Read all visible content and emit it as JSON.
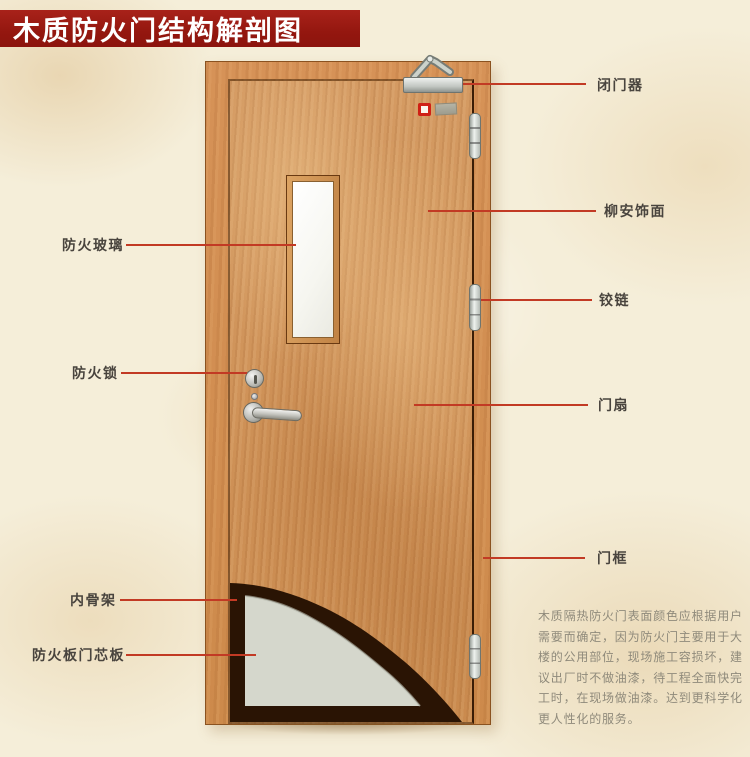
{
  "title": "木质防火门结构解剖图",
  "callouts": {
    "fire_glass": "防火玻璃",
    "fire_lock": "防火锁",
    "inner_skeleton": "内骨架",
    "fire_board_core": "防火板门芯板",
    "door_closer": "闭门器",
    "lauan_veneer": "柳安饰面",
    "hinge": "铰链",
    "door_leaf": "门扇",
    "door_frame": "门框"
  },
  "description": {
    "lines": [
      "木质隔热防火门表面颜色应根据用户",
      "需要而确定，因为防火门主要用于大",
      "楼的公用部位，现场施工容损坏，建",
      "议出厂时不做油漆，待工程全面快完",
      "工时，在现场做油漆。达到更科学化",
      "更人性化的服务。"
    ]
  },
  "colors": {
    "banner_red": "#94170f",
    "pointer_red": "#c23a24",
    "wood_leaf": "#d0925a",
    "wood_frame": "#d18c4f",
    "core_board_gray": "#d5d7cc",
    "skeleton_dark": "#2a1404",
    "background_parchment": "#f5eed9"
  }
}
